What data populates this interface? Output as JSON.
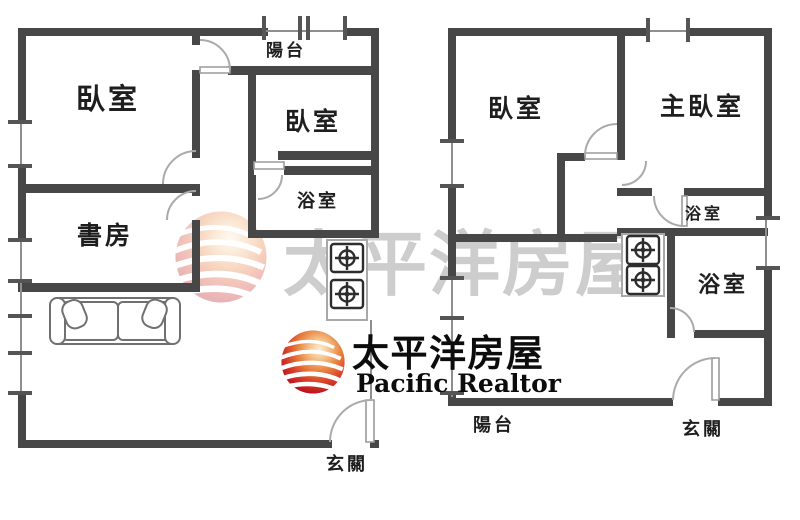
{
  "brand": {
    "name_zh": "太平洋房屋",
    "name_en": "Pacific Realtor"
  },
  "watermark": {
    "text": "太平洋房屋"
  },
  "plans": {
    "left": {
      "rooms": [
        {
          "id": "balcony",
          "label": "陽台"
        },
        {
          "id": "bedroom-large",
          "label": "臥室"
        },
        {
          "id": "bedroom-small",
          "label": "臥室"
        },
        {
          "id": "bathroom",
          "label": "浴室"
        },
        {
          "id": "study",
          "label": "書房"
        },
        {
          "id": "entry",
          "label": "玄關"
        }
      ]
    },
    "right": {
      "rooms": [
        {
          "id": "bedroom",
          "label": "臥室"
        },
        {
          "id": "master-bedroom",
          "label": "主臥室"
        },
        {
          "id": "bathroom-upper",
          "label": "浴室"
        },
        {
          "id": "bathroom-lower",
          "label": "浴室"
        },
        {
          "id": "balcony",
          "label": "陽台"
        },
        {
          "id": "entry",
          "label": "玄關"
        }
      ]
    }
  },
  "colors": {
    "wall": "#474747",
    "line": "#8f8f8f",
    "door": "#aaaaaa",
    "label": "#1e1e1e",
    "watermark_text": "#c8c8c8",
    "logo_text": "#0c0c0c",
    "logo_red": "#c2151c",
    "furniture": "#707070",
    "stove": "#2d2d2d",
    "stove_box": "#a8a8a8",
    "background": "#ffffff"
  }
}
